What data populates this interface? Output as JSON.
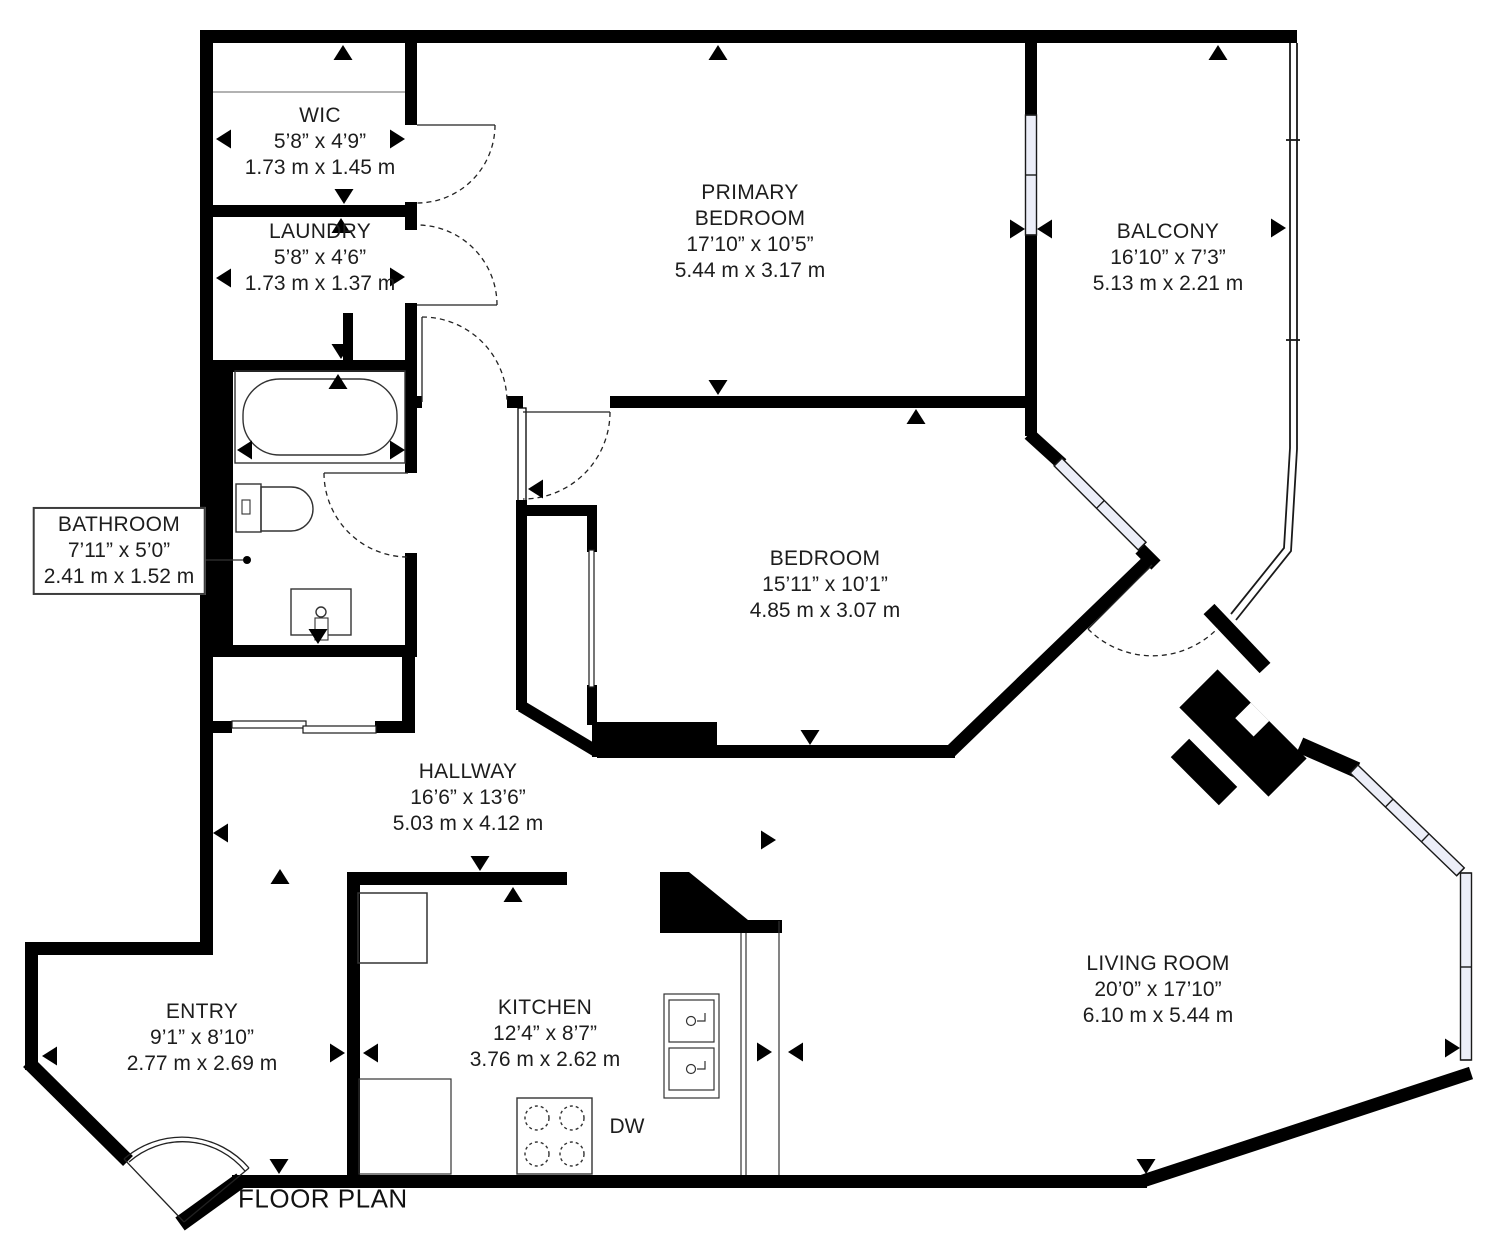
{
  "title": "FLOOR PLAN",
  "colors": {
    "wall": "#000000",
    "window_fill": "#eceef8",
    "text": "#1d1d1d"
  },
  "labels": {
    "dishwasher": "DW"
  },
  "rooms": [
    {
      "id": "wic",
      "name": "WIC",
      "imperial": "5’8” x 4’9”",
      "metric": "1.73 m x 1.45 m"
    },
    {
      "id": "laundry",
      "name": "LAUNDRY",
      "imperial": "5’8” x 4’6”",
      "metric": "1.73 m x 1.37 m"
    },
    {
      "id": "primary",
      "name": "PRIMARY BEDROOM",
      "imperial": "17’10” x 10’5”",
      "metric": "5.44 m x 3.17 m"
    },
    {
      "id": "balcony",
      "name": "BALCONY",
      "imperial": "16’10” x 7’3”",
      "metric": "5.13 m x 2.21 m"
    },
    {
      "id": "bathroom",
      "name": "BATHROOM",
      "imperial": "7’11” x 5’0”",
      "metric": "2.41 m x 1.52 m"
    },
    {
      "id": "bedroom",
      "name": "BEDROOM",
      "imperial": "15’11” x 10’1”",
      "metric": "4.85 m x 3.07 m"
    },
    {
      "id": "hallway",
      "name": "HALLWAY",
      "imperial": "16’6” x 13’6”",
      "metric": "5.03 m x 4.12 m"
    },
    {
      "id": "entry",
      "name": "ENTRY",
      "imperial": "9’1” x 8’10”",
      "metric": "2.77 m x 2.69 m"
    },
    {
      "id": "kitchen",
      "name": "KITCHEN",
      "imperial": "12’4” x 8’7”",
      "metric": "3.76 m x 2.62 m"
    },
    {
      "id": "living",
      "name": "LIVING ROOM",
      "imperial": "20’0” x 17’10”",
      "metric": "6.10 m x 5.44 m"
    }
  ]
}
